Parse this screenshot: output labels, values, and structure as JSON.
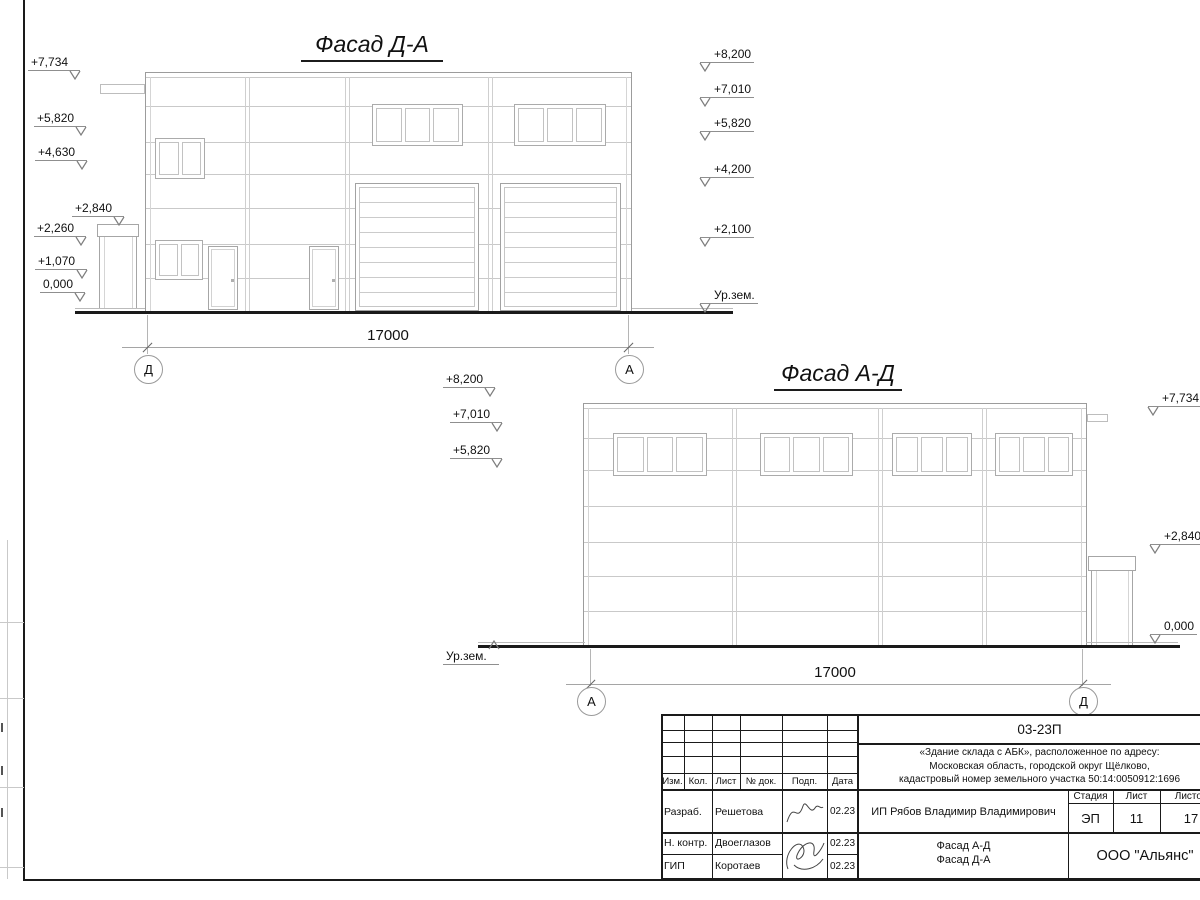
{
  "facade1": {
    "title": "Фасад Д-А",
    "left_marks": [
      "+7,734",
      "+5,820",
      "+4,630",
      "+2,840",
      "+2,260",
      "+1,070",
      "0,000"
    ],
    "right_marks": [
      "+8,200",
      "+7,010",
      "+5,820",
      "+4,200",
      "+2,100"
    ],
    "ground_label": "Ур.зем.",
    "dimension": "17000",
    "axis_left": "Д",
    "axis_right": "А"
  },
  "facade2": {
    "title": "Фасад А-Д",
    "left_marks": [
      "+8,200",
      "+7,010",
      "+5,820"
    ],
    "right_marks": [
      "+7,734",
      "+2,840",
      "0,000"
    ],
    "ground_label": "Ур.зем.",
    "dimension": "17000",
    "axis_left": "А",
    "axis_right": "Д"
  },
  "titleblock": {
    "doc_number": "03-23П",
    "project_line1": "«Здание склада с АБК», расположенное по адресу:",
    "project_line2": "Московская область, городской округ Щёлково,",
    "project_line3": "кадастровый номер земельного участка 50:14:0050912:1696",
    "col_headers": [
      "Изм.",
      "Кол.",
      "Лист",
      "№ док.",
      "Подп.",
      "Дата"
    ],
    "row1_role": "Разраб.",
    "row1_name": "Решетова",
    "row1_date": "02.23",
    "row2_role": "Н. контр.",
    "row2_name": "Двоеглазов",
    "row2_date": "02.23",
    "row3_role": "ГИП",
    "row3_name": "Коротаев",
    "row3_date": "02.23",
    "client": "ИП Рябов Владимир Владимирович",
    "stage_header": "Стадия",
    "sheet_header": "Лист",
    "sheets_header": "Листов",
    "stage_value": "ЭП",
    "sheet_value": "11",
    "sheets_value": "17",
    "sheet_name_line1": "Фасад А-Д",
    "sheet_name_line2": "Фасад Д-А",
    "company": "ООО \"Альянс\""
  }
}
